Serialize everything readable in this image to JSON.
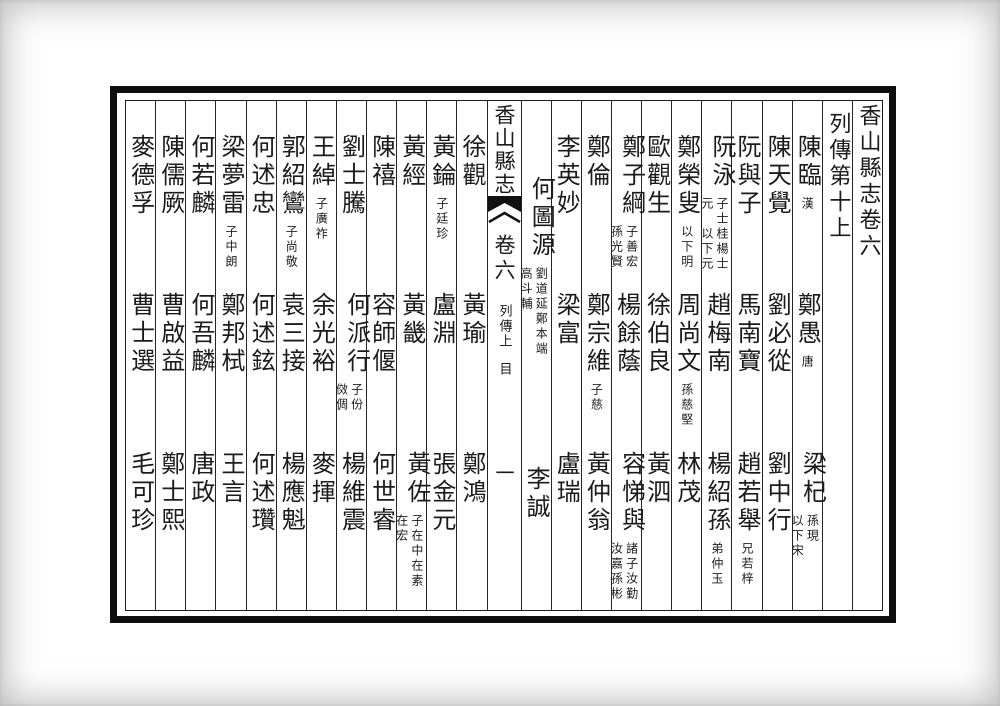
{
  "page": {
    "volume_title": "香山縣志卷六",
    "section_title": "列傳第十上",
    "ink_color": "#1b1b1b",
    "paper_color": "#ffffff"
  },
  "spine": {
    "title": "香山縣志",
    "volume": "卷六",
    "section": "列傳上",
    "section_sub": "目",
    "page_number": "一",
    "fishtail_mark": "black-fishtail"
  },
  "cols": [
    {
      "e": [
        {
          "n": "陳臨",
          "a": "漢"
        },
        {
          "n": "鄭愚",
          "a": "唐"
        },
        {
          "n": "梁杞",
          "ar": "孫現",
          "al": "以下宋"
        }
      ]
    },
    {
      "e": [
        {
          "n": "陳天覺"
        },
        {
          "n": "劉必從"
        },
        {
          "n": "劉中行"
        }
      ]
    },
    {
      "e": [
        {
          "n": "阮與子"
        },
        {
          "n": "馬南寶"
        },
        {
          "n": "趙若舉",
          "a": "兄若梓"
        }
      ]
    },
    {
      "e": [
        {
          "n": "阮泳",
          "ar": "子士桂楊士",
          "al": "元　以下元"
        },
        {
          "n": "趙梅南"
        },
        {
          "n": "楊紹孫",
          "a": "弟仲玉"
        }
      ]
    },
    {
      "e": [
        {
          "n": "鄭榮叟",
          "a": "以下明"
        },
        {
          "n": "周尚文",
          "a": "孫慈堅"
        },
        {
          "n": "林茂"
        }
      ]
    },
    {
      "e": [
        {
          "n": "歐觀生"
        },
        {
          "n": "徐伯良"
        },
        {
          "n": "黃泗"
        }
      ]
    },
    {
      "e": [
        {
          "n": "鄭子綱",
          "ar": "子善宏",
          "al": "孫光賢"
        },
        {
          "n": "楊餘蔭"
        },
        {
          "n": "容悌與",
          "ar": "諸子汝勤",
          "al": "汝嘉孫彬"
        }
      ]
    },
    {
      "e": [
        {
          "n": "鄭倫"
        },
        {
          "n": "鄭宗維",
          "a": "子慈"
        },
        {
          "n": "黃仲翁"
        }
      ]
    },
    {
      "e": [
        {
          "n": "李英妙"
        },
        {
          "n": "梁富"
        },
        {
          "n": "盧瑞"
        }
      ]
    },
    {
      "e": [
        {
          "n": "何圖源",
          "ar": "劉道延鄭本端",
          "al": "高斗輔"
        },
        {
          "n": "李誠"
        }
      ]
    },
    {
      "e": [
        {
          "n": "徐觀"
        },
        {
          "n": "黃瑜"
        },
        {
          "n": "鄭鴻"
        }
      ]
    },
    {
      "e": [
        {
          "n": "黃錀",
          "a": "子廷珍"
        },
        {
          "n": "盧淵"
        },
        {
          "n": "張金元"
        }
      ]
    },
    {
      "e": [
        {
          "n": "黃經"
        },
        {
          "n": "黃畿"
        },
        {
          "n": "黃佐",
          "ar": "子在中在素",
          "al": "在宏"
        }
      ]
    },
    {
      "e": [
        {
          "n": "陳禧"
        },
        {
          "n": "容師偃"
        },
        {
          "n": "何世睿"
        }
      ]
    },
    {
      "e": [
        {
          "n": "劉士騰"
        },
        {
          "n": "何派行",
          "ar": "子份",
          "al": "傚倜"
        },
        {
          "n": "楊維震"
        }
      ]
    },
    {
      "e": [
        {
          "n": "王綽",
          "a": "子廣祚"
        },
        {
          "n": "余光裕"
        },
        {
          "n": "麥揮"
        }
      ]
    },
    {
      "e": [
        {
          "n": "郭紹鸞",
          "a": "子尚敬"
        },
        {
          "n": "袁三接"
        },
        {
          "n": "楊應魁"
        }
      ]
    },
    {
      "e": [
        {
          "n": "何述忠"
        },
        {
          "n": "何述鉉"
        },
        {
          "n": "何述瓚"
        }
      ]
    },
    {
      "e": [
        {
          "n": "梁夢雷",
          "a": "子中朗"
        },
        {
          "n": "鄭邦栻"
        },
        {
          "n": "王言"
        }
      ]
    },
    {
      "e": [
        {
          "n": "何若麟"
        },
        {
          "n": "何吾麟"
        },
        {
          "n": "唐政"
        }
      ]
    },
    {
      "e": [
        {
          "n": "陳儒厥"
        },
        {
          "n": "曹啟益"
        },
        {
          "n": "鄭士熙"
        }
      ]
    },
    {
      "e": [
        {
          "n": "麥德孚"
        },
        {
          "n": "曹士選"
        },
        {
          "n": "毛可珍"
        }
      ]
    }
  ]
}
